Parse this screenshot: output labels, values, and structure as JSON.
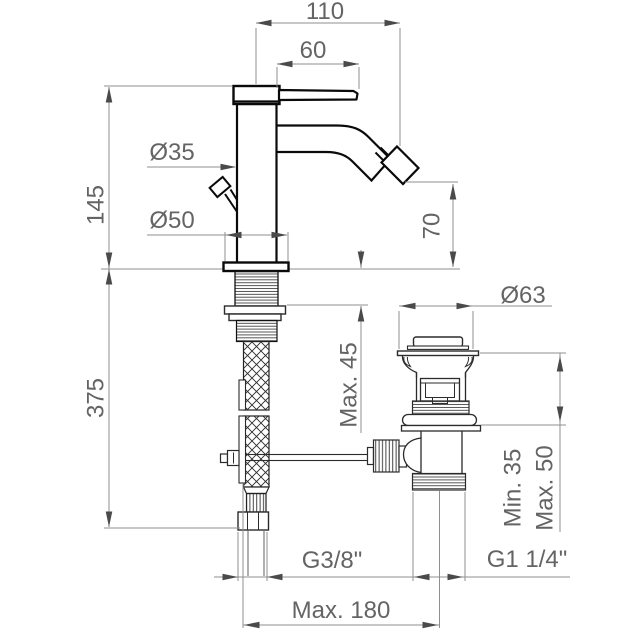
{
  "drawing": {
    "title": "Bidet single-lever mixer with pop-up waste — installation dimensions",
    "background": "#ffffff",
    "colors": {
      "object_outline": "#0a0a0a",
      "waste_outline": "#2b2b2b",
      "dimension_line": "#8f8f8f",
      "arrow": "#4a4a4a",
      "text": "#646464"
    },
    "dimensions": {
      "spout_reach": {
        "label": "110"
      },
      "handle_length": {
        "label": "60"
      },
      "body_height": {
        "label": "145"
      },
      "installation_depth": {
        "label": "375"
      },
      "body_diameter": {
        "label": "Ø35"
      },
      "base_diameter": {
        "label": "Ø50"
      },
      "spout_height": {
        "label": "70"
      },
      "waste_flange_diameter": {
        "label": "Ø63"
      },
      "max_deck_thickness": {
        "label": "Max. 45"
      },
      "waste_min_deck": {
        "label": "Min. 35"
      },
      "waste_max_deck": {
        "label": "Max. 50"
      },
      "supply_connection": {
        "label": "G3/8\""
      },
      "waste_connection": {
        "label": "G1 1/4\""
      },
      "max_center_distance": {
        "label": "Max. 180"
      }
    }
  }
}
